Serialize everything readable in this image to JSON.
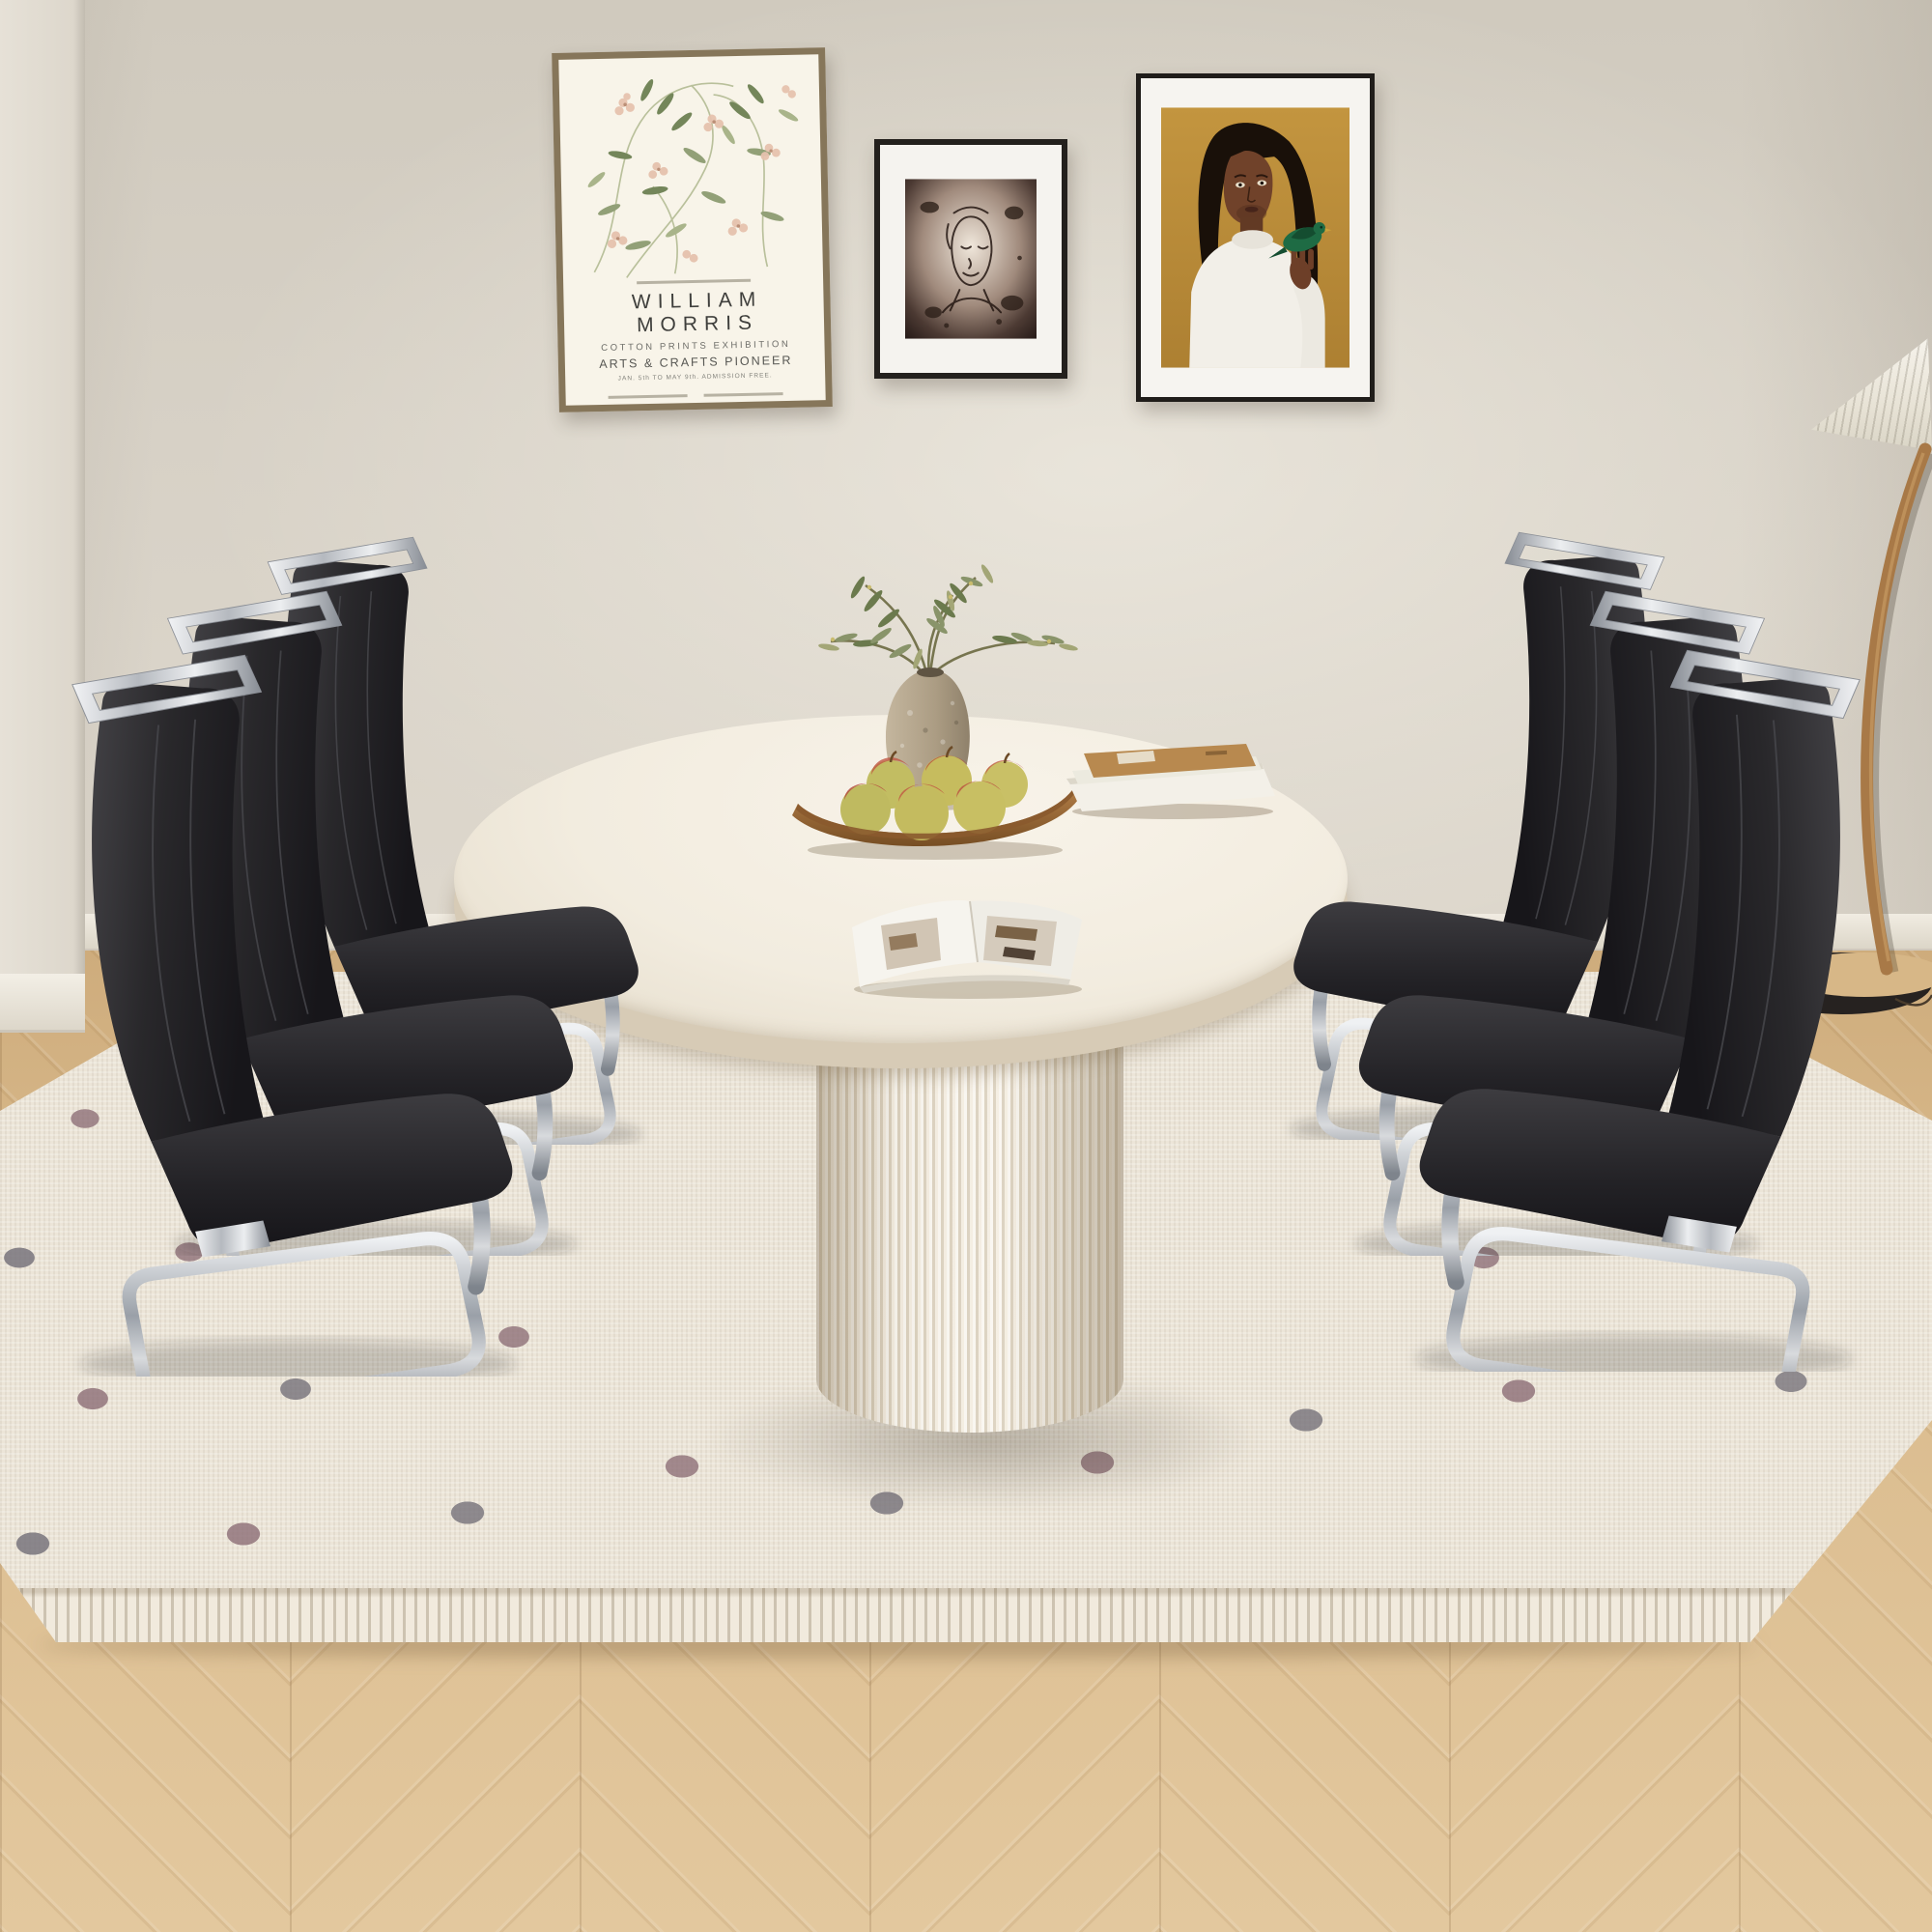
{
  "scene": {
    "alt_text": "Beige dining room: cream oval pedestal dining table with fluted base on a polka-dot boucle rug, three black faux-leather cantilever chairs with chrome frames on each side, gallery wall with three artworks, pleated floor lamp at right, chevron oak floor",
    "chair_count": 6,
    "apple_count": 6,
    "frame_count": 3
  },
  "poster": {
    "title": "WILLIAM MORRIS",
    "line1": "COTTON PRINTS EXHIBITION",
    "line2": "ARTS & CRAFTS PIONEER",
    "line3": "JAN. 5th TO MAY 9th. ADMISSION FREE."
  },
  "palette": {
    "wall": "#d7d1c6",
    "baseboard": "#f1ece2",
    "floor_oak": "#d9ba8c",
    "rug": "#ece5d8",
    "rug_dot_gray": "#78747c",
    "rug_dot_mauve": "#8e7078",
    "chair_leather": "#2b2a2b",
    "chrome": "#c6c8cc",
    "table_top": "#f2ecdf",
    "table_base_fluted": "#ece5d7",
    "poster_frame_wood": "#86765a",
    "art_frame_black": "#201d1a",
    "painting_ochre": "#bd8d3c",
    "bird_green": "#1e6b44",
    "lamp_wood": "#a87947",
    "apple_green": "#c2bd62",
    "apple_red": "#c05844",
    "bowl_wood": "#a5713c"
  }
}
